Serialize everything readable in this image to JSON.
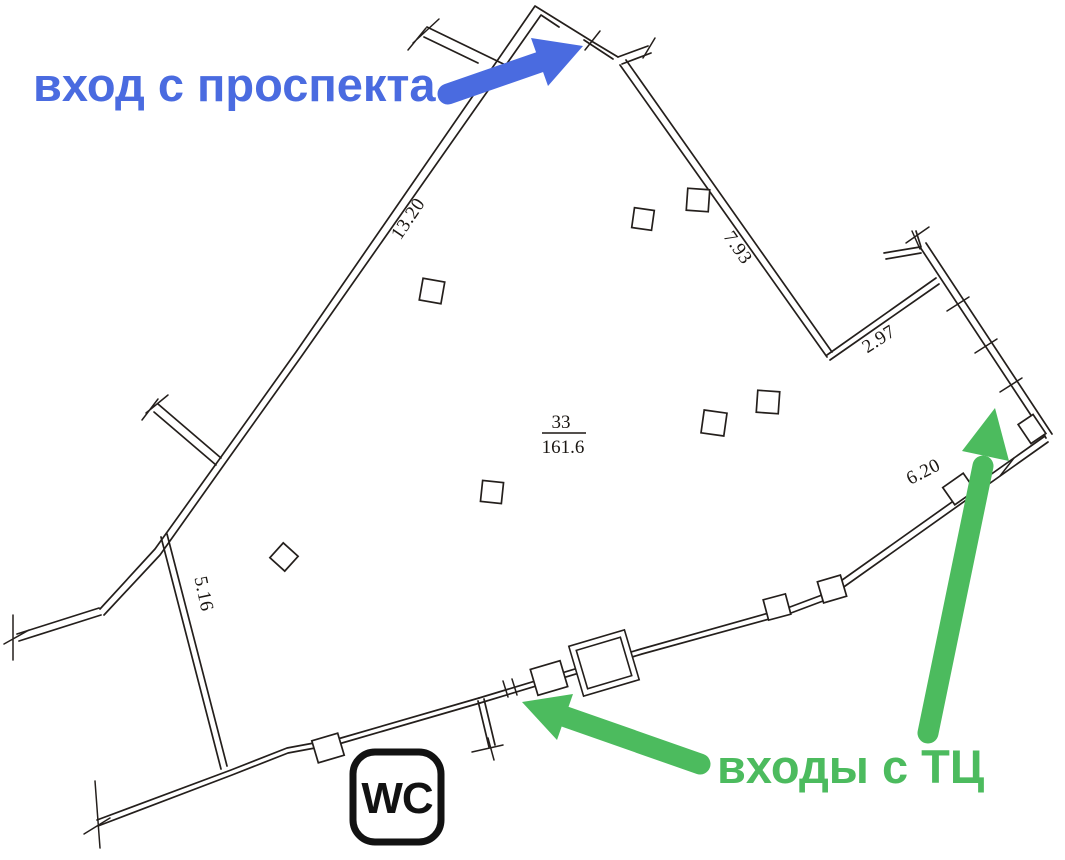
{
  "annotations": {
    "avenue_entrance": {
      "label": "вход с проспекта",
      "color": "#4a6be0"
    },
    "mall_entrances": {
      "label": "входы с ТЦ",
      "color": "#4cbb5e"
    }
  },
  "plan": {
    "line_color": "#241f1c",
    "room_label": {
      "number": "33",
      "area": "161.6"
    },
    "wc_label": "WC",
    "dimensions": [
      {
        "value": "13.20"
      },
      {
        "value": "7.93"
      },
      {
        "value": "2.97"
      },
      {
        "value": "6.20"
      },
      {
        "value": "5.16"
      }
    ]
  }
}
